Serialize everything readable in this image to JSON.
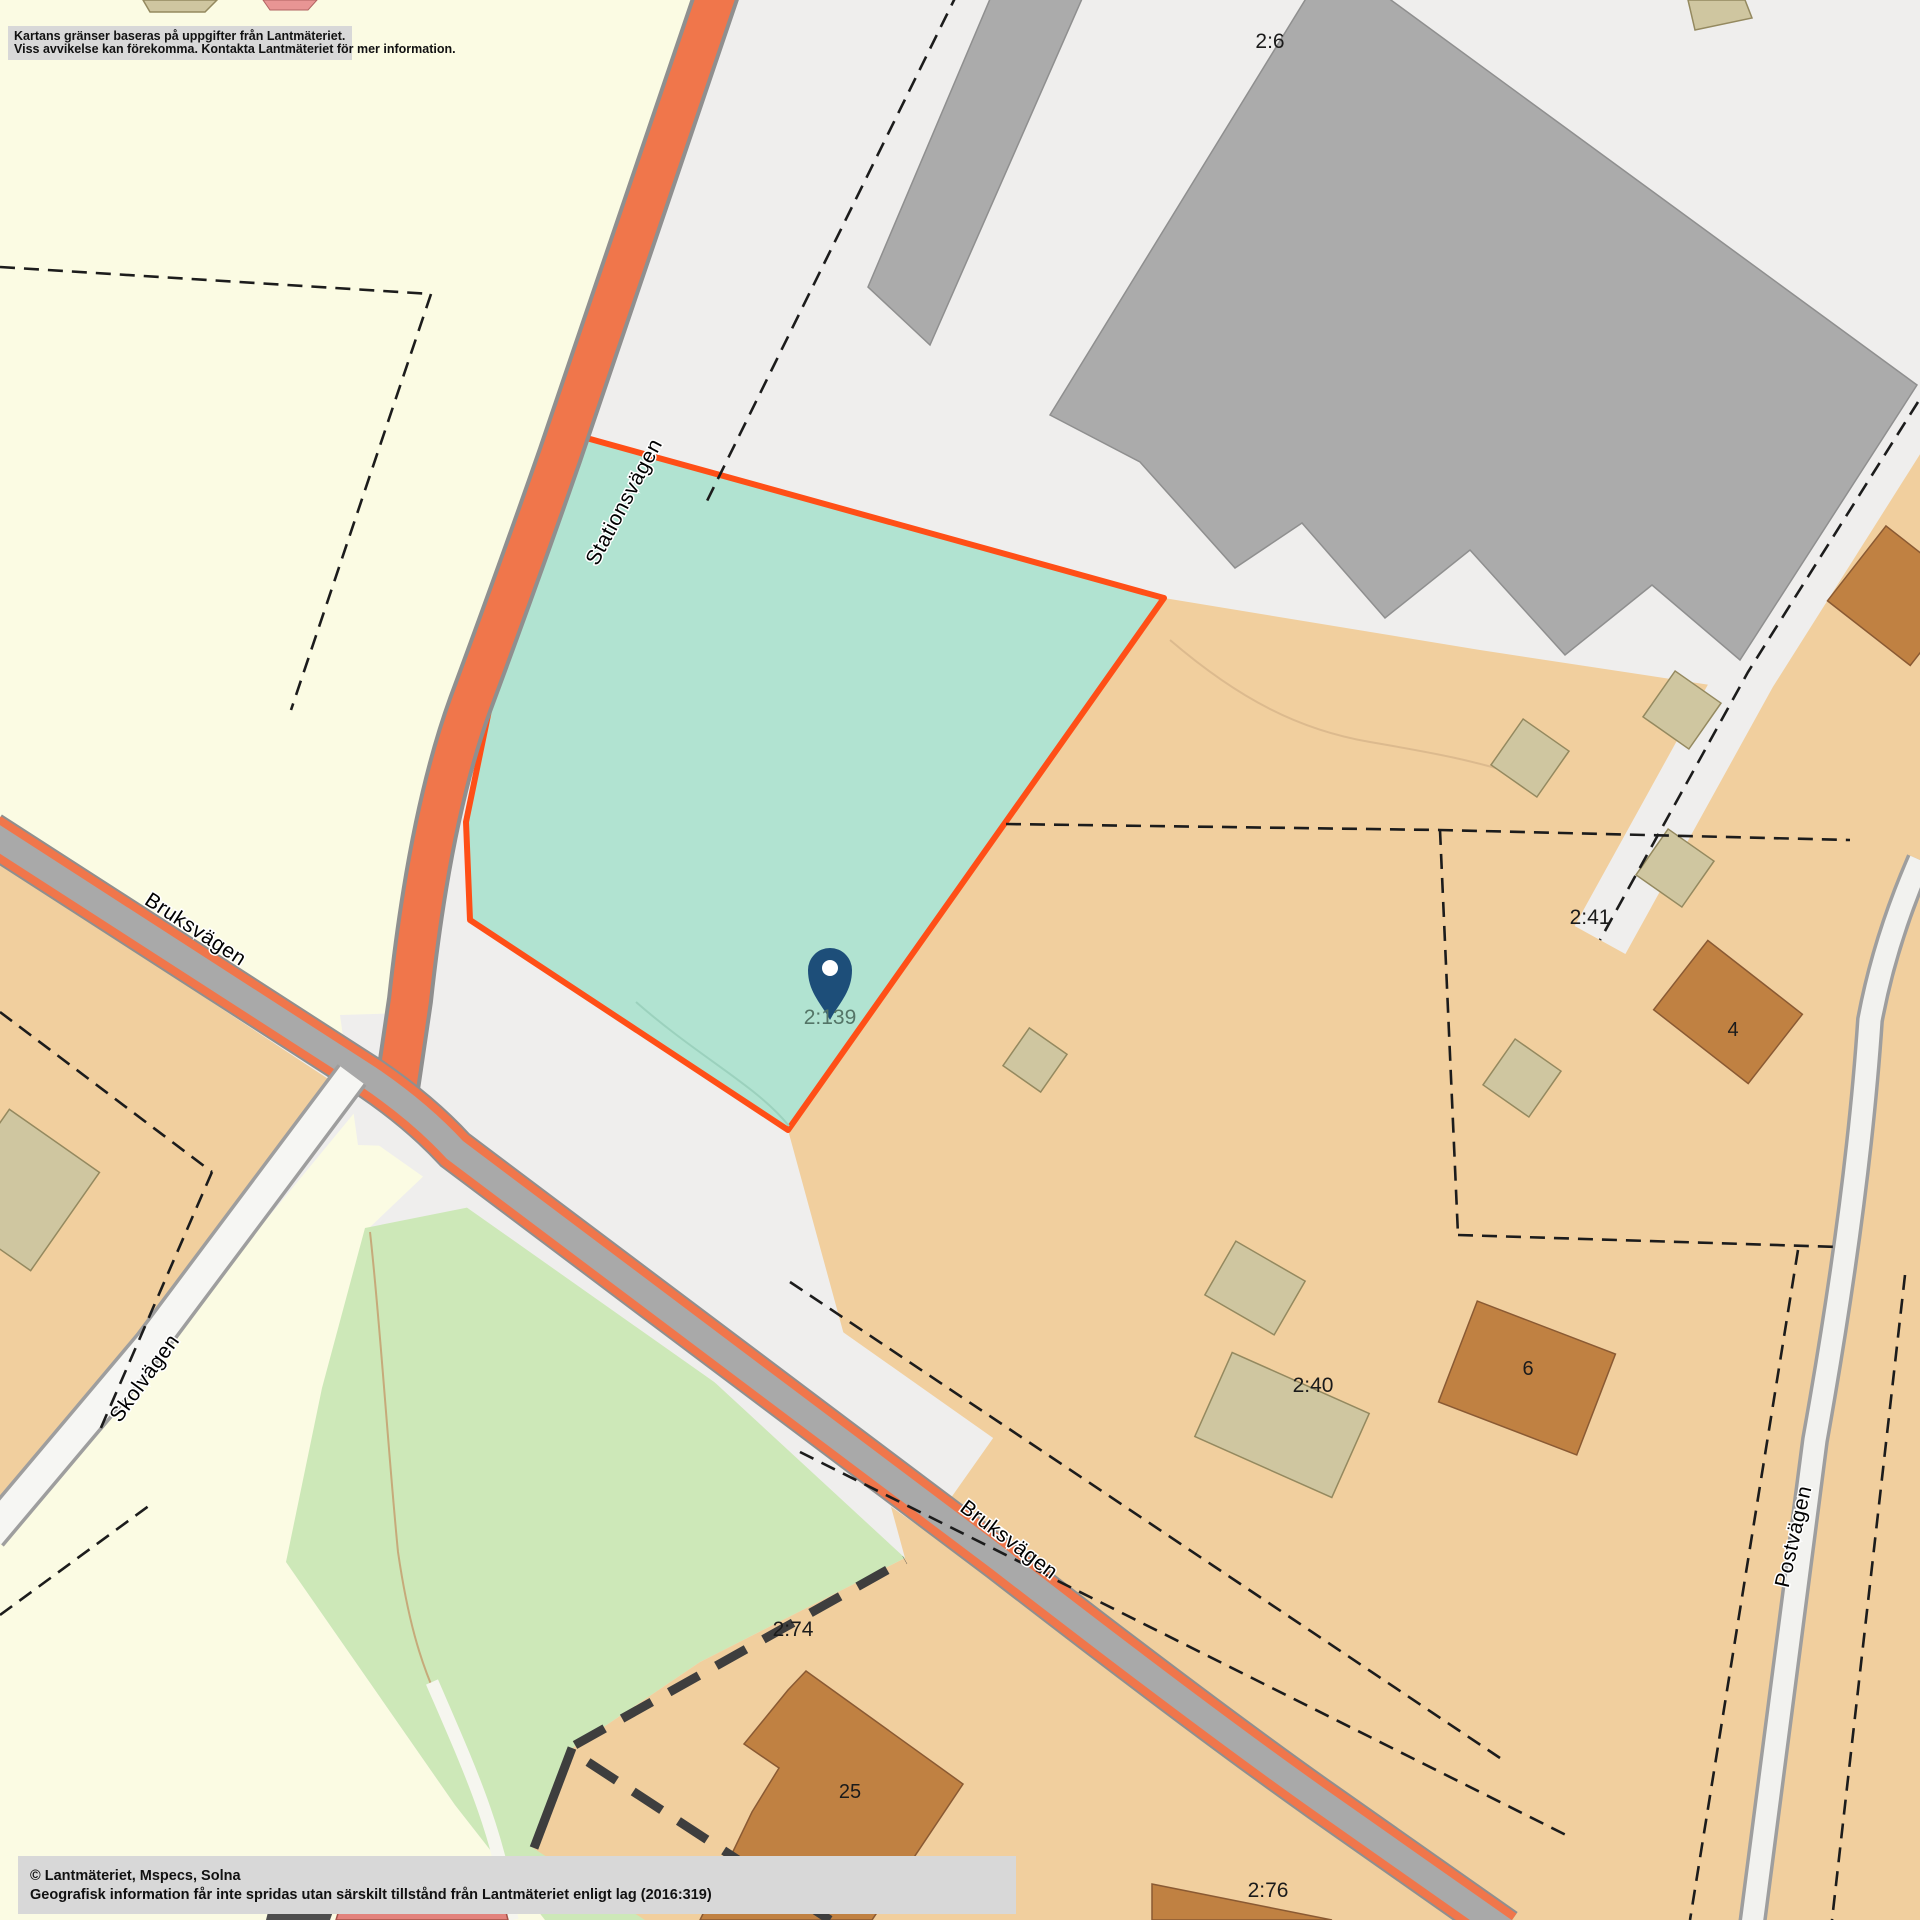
{
  "map": {
    "disclaimer": {
      "line1": "Kartans gränser baseras på uppgifter från Lantmäteriet.",
      "line2": "Viss avvikelse kan förekomma. Kontakta Lantmäteriet för mer information."
    },
    "attribution": {
      "line1": "© Lantmäteriet, Mspecs, Solna",
      "line2": "Geografisk information får inte spridas utan särskilt tillstånd från Lantmäteriet enligt lag (2016:319)"
    },
    "selected_parcel": {
      "id": "2:139"
    },
    "parcels": [
      {
        "id": "2:6"
      },
      {
        "id": "2:41"
      },
      {
        "id": "2:40"
      },
      {
        "id": "2:74"
      },
      {
        "id": "2:76"
      }
    ],
    "buildings": [
      {
        "number": "4"
      },
      {
        "number": "6"
      },
      {
        "number": "25"
      }
    ],
    "streets": [
      {
        "name": "Stationsvägen"
      },
      {
        "name": "Bruksvägen"
      },
      {
        "name": "Skolvägen"
      },
      {
        "name": "Bruksvägen"
      },
      {
        "name": "Postvägen"
      }
    ],
    "colors": {
      "highlight_fill": "#b1e3d1",
      "highlight_border": "#ff4f17",
      "marker": "#1d4e79",
      "road_orange": "#f0764b",
      "parcel_orange": "#f1cf9e",
      "building_gray": "#ababab",
      "forest_green": "#cde8b8",
      "map_yellow": "#fbfbe3"
    }
  }
}
